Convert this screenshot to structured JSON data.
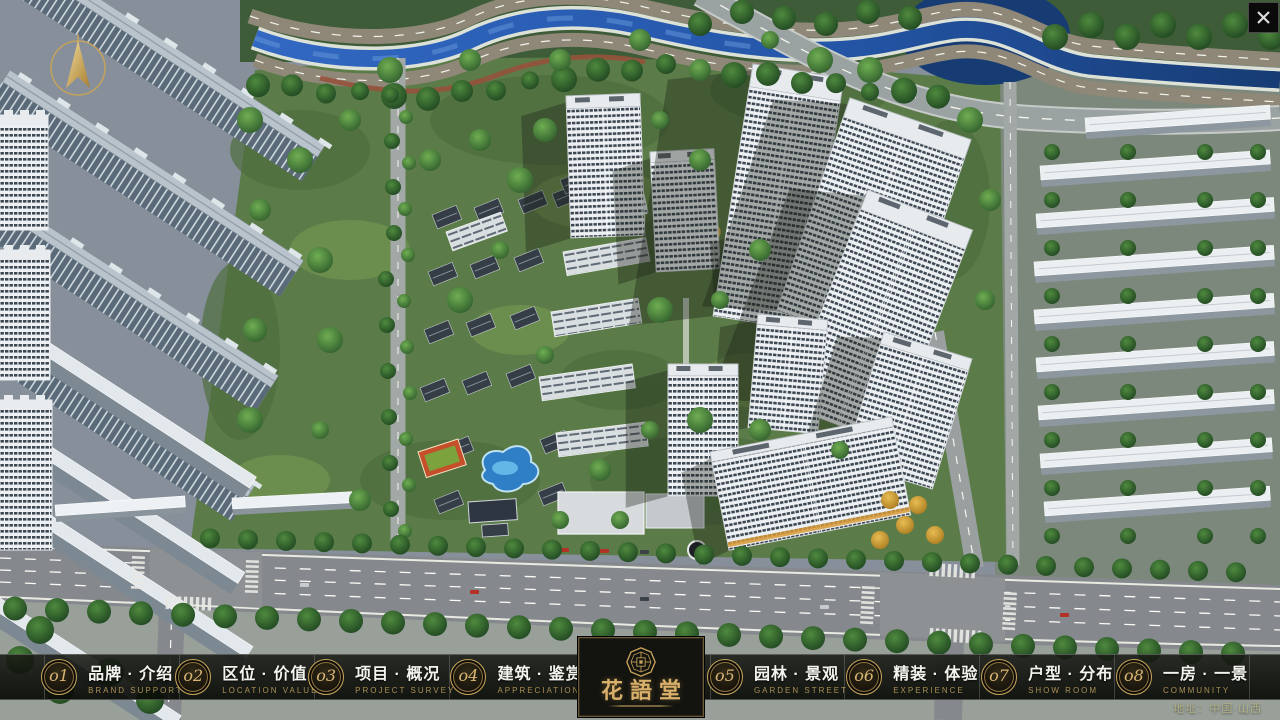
{
  "window": {
    "icons": {
      "close": "x-mark",
      "compass": "gold-north-arrow",
      "logo_seal": "octagon-maze-seal"
    }
  },
  "project": {
    "logo_name": "花語堂",
    "address": "地址：中国·山西"
  },
  "navbar": {
    "items": [
      {
        "num": "o1",
        "title": "品牌 · 介绍",
        "subtitle": "BRAND SUPPORT"
      },
      {
        "num": "o2",
        "title": "区位 · 价值",
        "subtitle": "LOCATION VALUE"
      },
      {
        "num": "o3",
        "title": "项目 · 概况",
        "subtitle": "PROJECT SURVEY"
      },
      {
        "num": "o4",
        "title": "建筑 · 鉴赏",
        "subtitle": "APPRECIATION"
      },
      {
        "num": "o5",
        "title": "园林 · 景观",
        "subtitle": "GARDEN STREET"
      },
      {
        "num": "o6",
        "title": "精装 · 体验",
        "subtitle": "EXPERIENCE"
      },
      {
        "num": "o7",
        "title": "户型 · 分布",
        "subtitle": "SHOW ROOM"
      },
      {
        "num": "o8",
        "title": "一房 · 一景",
        "subtitle": "COMMUNITY"
      }
    ]
  },
  "colors": {
    "accent_gold": "#c9a35a",
    "navbar_bg": "#0b0d09",
    "water_blue": "#2456a8",
    "subtitle_gold": "#a98f54",
    "title_white": "#f4f4ef"
  }
}
